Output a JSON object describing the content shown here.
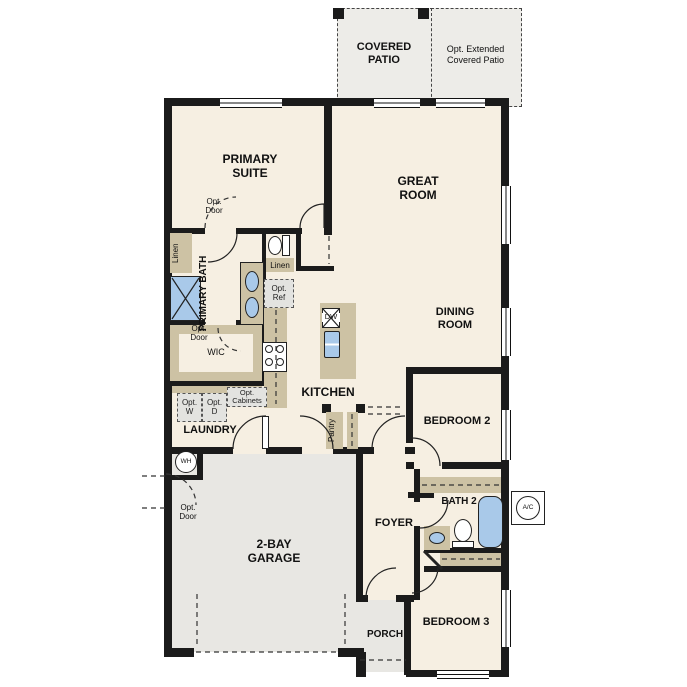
{
  "colors": {
    "room_fill": "#f6efe2",
    "garage_fill": "#e8e7e3",
    "patio_fill": "#edece8",
    "cabinet_tan": "#cdc2a4",
    "fixture_blue": "#a9c9e9",
    "wall": "#1b1b1b",
    "optional_fill": "#e3e3e0"
  },
  "labels": {
    "covered_patio": "COVERED PATIO",
    "opt_extended_patio": "Opt. Extended Covered Patio",
    "primary_suite": "PRIMARY SUITE",
    "great_room": "GREAT ROOM",
    "dining_room": "DINING ROOM",
    "primary_bath": "PRIMARY BATH",
    "opt_door": "Opt. Door",
    "linen": "Linen",
    "opt_ref": "Opt. Ref",
    "wic": "WIC",
    "opt_w": "Opt. W",
    "opt_d": "Opt. D",
    "opt_cabinets": "Opt. Cabinets",
    "laundry": "LAUNDRY",
    "kitchen": "KITCHEN",
    "pantry": "Pantry",
    "dw": "DW",
    "bedroom2": "BEDROOM 2",
    "bath2": "BATH 2",
    "foyer": "FOYER",
    "garage": "2-BAY GARAGE",
    "porch": "PORCH",
    "bedroom3": "BEDROOM 3",
    "wh": "WH",
    "ac": "A/C"
  }
}
